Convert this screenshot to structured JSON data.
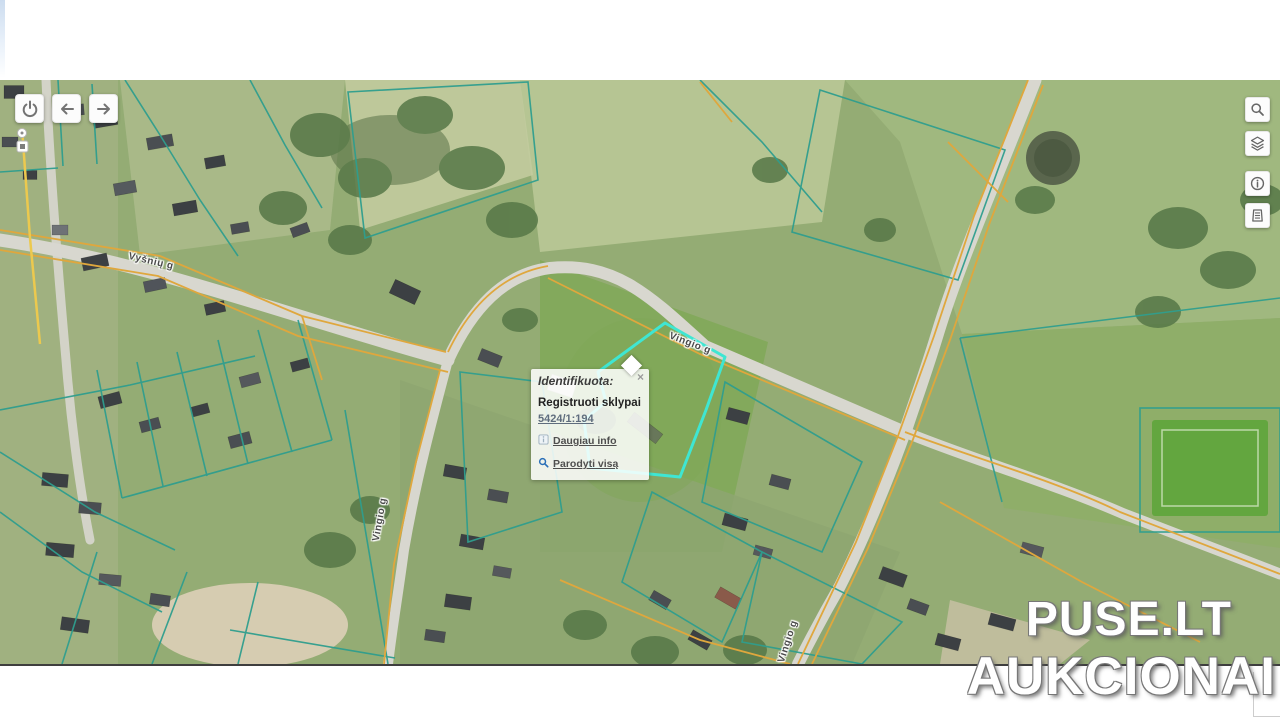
{
  "popup": {
    "title": "Identifikuota:",
    "close_label": "×",
    "result_layer": "Registruoti sklypai",
    "parcel_code": "5424/1:194",
    "more_info_label": "Daugiau info",
    "show_all_label": "Parodyti visą"
  },
  "map": {
    "street_labels": [
      {
        "text": "Vyšnių g"
      },
      {
        "text": "Vingio g"
      },
      {
        "text": "Vingio g"
      },
      {
        "text": "Vingio g"
      }
    ],
    "colors": {
      "parcel_boundary_teal": "#2f9e8e",
      "parcel_boundary_orange": "#dfa73d",
      "selected_parcel_cyan": "#3fe6d2",
      "road_gray": "#d8d7cf"
    }
  },
  "watermark": {
    "line1": "PUSE.LT",
    "line2": "AUKCIONAI"
  }
}
